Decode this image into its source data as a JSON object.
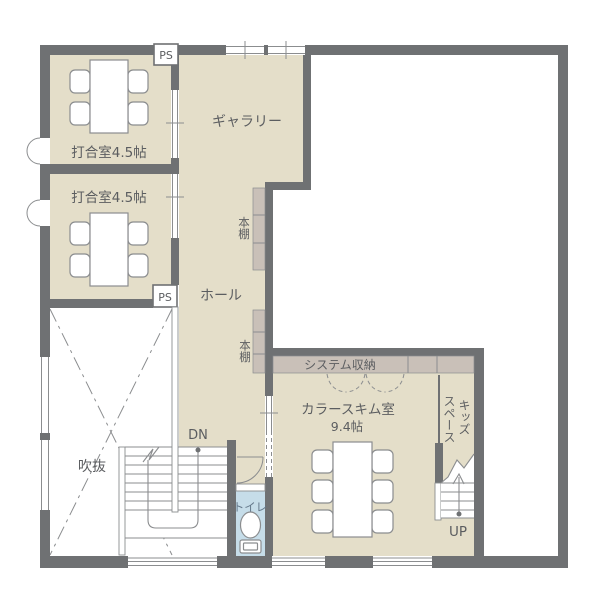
{
  "colors": {
    "floor": "#e4dec9",
    "wall": "#6f7173",
    "shelf": "#c9c0b8",
    "toilet": "#c6dde9",
    "line": "#8b8d8f",
    "text": "#5b5d60",
    "toilet_text": "#64788a"
  },
  "labels": {
    "meeting_room_1": "打合室4.5帖",
    "meeting_room_2": "打合室4.5帖",
    "gallery": "ギャラリー",
    "hall": "ホール",
    "bookshelf_upper": "本棚",
    "bookshelf_lower": "本棚",
    "system_storage": "システム収納",
    "color_scheme_room": "カラースキム室",
    "color_scheme_room_size": "9.4帖",
    "kids_space_line_1": "キッズ",
    "kids_space_line_2": "スペース",
    "void": "吹抜",
    "toilet": "トイレ",
    "stairs_down": "DN",
    "stairs_up": "UP",
    "ps_top": "PS",
    "ps_middle": "PS"
  }
}
